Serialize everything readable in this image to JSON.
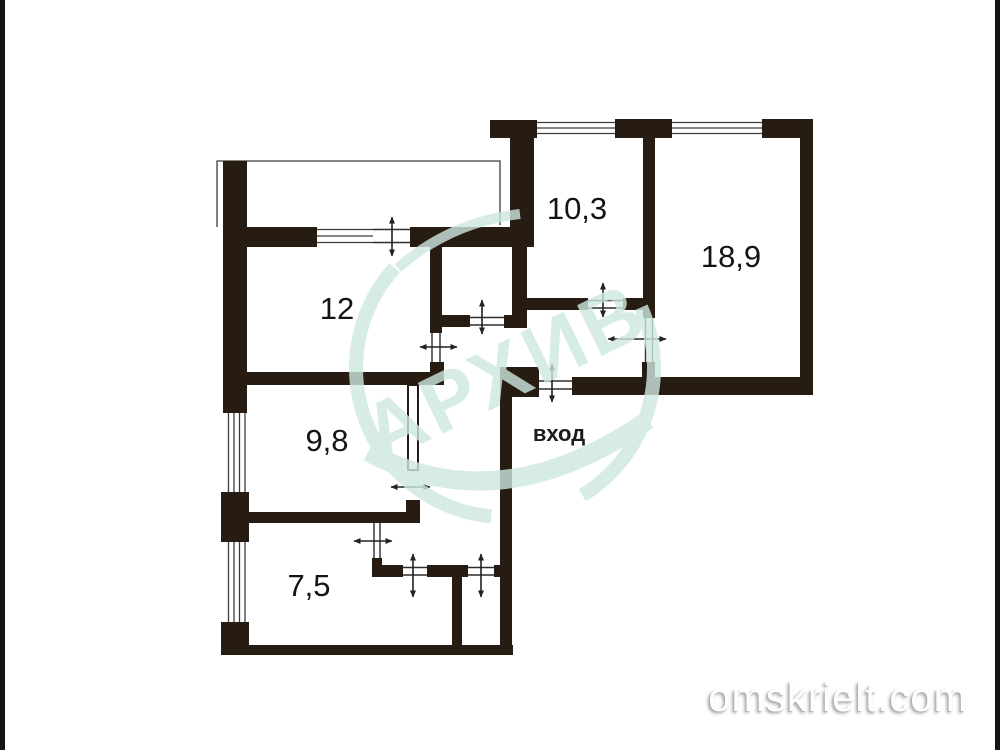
{
  "floorplan": {
    "rooms": [
      {
        "name": "living-room",
        "label": "12"
      },
      {
        "name": "bedroom-small",
        "label": "10,3"
      },
      {
        "name": "bedroom-large",
        "label": "18,9"
      },
      {
        "name": "room-98",
        "label": "9,8"
      },
      {
        "name": "kitchen",
        "label": "7,5"
      }
    ],
    "entrance_label": "вход",
    "stamp_watermark": "АРХИВ",
    "site_watermark": "omskrielt.com",
    "colors": {
      "wall": "#261c11",
      "stamp": "#cfe8e1",
      "label": "#141414",
      "site_text": "#fefefe"
    }
  }
}
